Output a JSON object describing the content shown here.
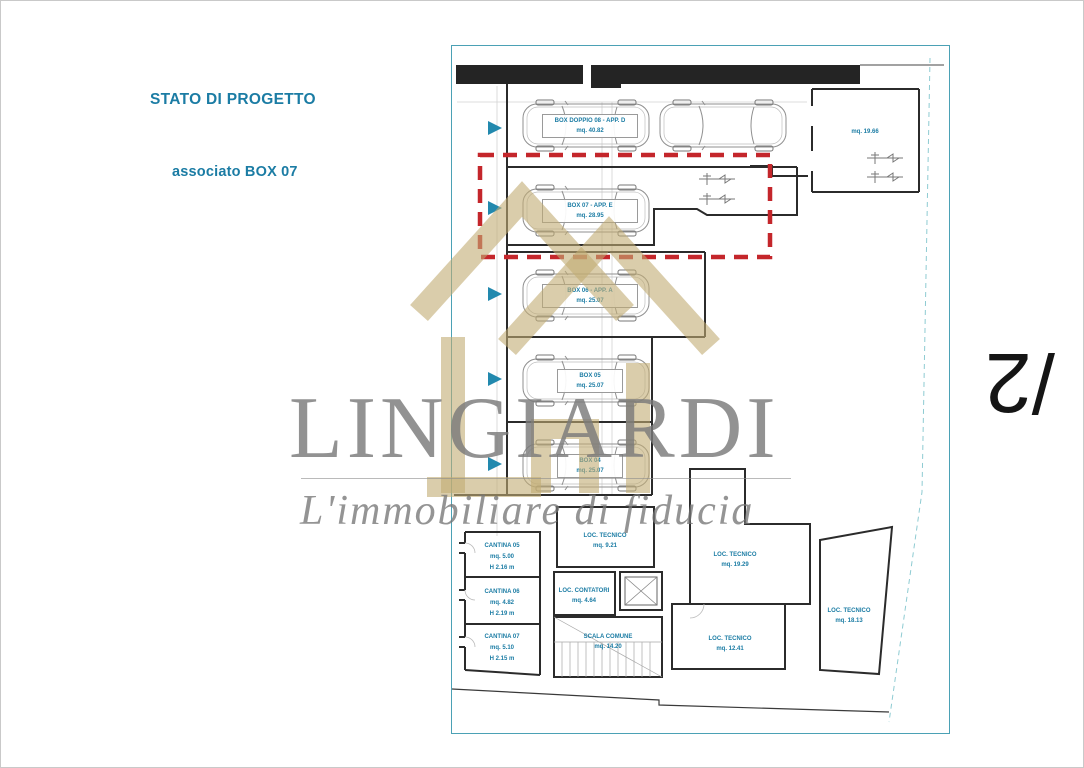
{
  "header": {
    "title": "STATO DI PROGETTO",
    "subtitle": "associato BOX 07"
  },
  "watermark": {
    "brand": "LINGIARDI",
    "tagline": "L'immobiliare di fiducia"
  },
  "page_marker": "/2",
  "colors": {
    "accent_teal": "#1b7ca4",
    "plan_border_teal": "#4ba1b5",
    "highlight_red": "#c4262b",
    "watermark_beige": "#d5c8a5",
    "watermark_gray": "#9b9b9b"
  },
  "plan": {
    "boxes": [
      {
        "id": "box-08",
        "line1": "BOX DOPPIO 08 - APP. D",
        "line2": "mq. 40.82"
      },
      {
        "id": "box-07",
        "line1": "BOX 07 - APP. E",
        "line2": "mq. 28.95"
      },
      {
        "id": "box-06",
        "line1": "BOX 06 - APP. A",
        "line2": "mq. 25.07"
      },
      {
        "id": "box-05",
        "line1": "BOX 05",
        "line2": "mq. 25.07"
      },
      {
        "id": "box-04",
        "line1": "BOX 04",
        "line2": "mq. 25.07"
      }
    ],
    "right_room": {
      "label": "mq. 19.66"
    },
    "cellars": [
      {
        "name": "CANTINA 05",
        "area": "mq. 5.00",
        "height": "H 2.16 m"
      },
      {
        "name": "CANTINA 06",
        "area": "mq. 4.82",
        "height": "H 2.19 m"
      },
      {
        "name": "CANTINA 07",
        "area": "mq. 5.10",
        "height": "H 2.15 m"
      }
    ],
    "service_rooms": [
      {
        "name": "LOC. TECNICO",
        "area": "mq. 9.21"
      },
      {
        "name": "LOC. CONTATORI",
        "area": "mq. 4.64"
      },
      {
        "name": "SCALA COMUNE",
        "area": "mq. 14.20"
      },
      {
        "name": "LOC. TECNICO",
        "area": "mq. 19.29"
      },
      {
        "name": "LOC. TECNICO",
        "area": "mq. 12.41"
      },
      {
        "name": "LOC. TECNICO",
        "area": "mq. 18.13"
      }
    ]
  }
}
